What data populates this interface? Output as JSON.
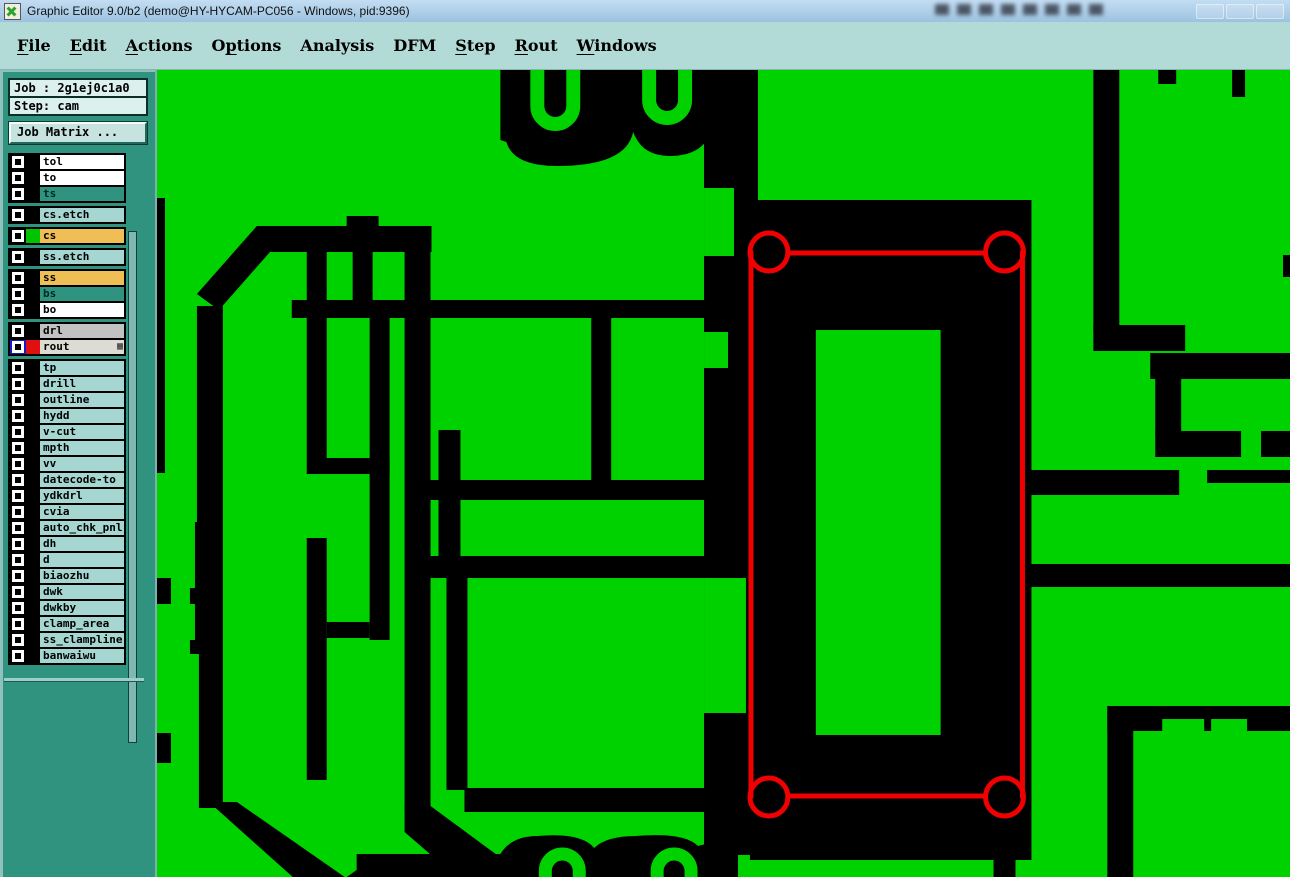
{
  "window": {
    "title": "Graphic Editor 9.0/b2 (demo@HY-HYCAM-PC056 - Windows, pid:9396)"
  },
  "menu": {
    "items": [
      {
        "label": "File",
        "u": 0
      },
      {
        "label": "Edit",
        "u": 0
      },
      {
        "label": "Actions",
        "u": 0
      },
      {
        "label": "Options",
        "u": 1
      },
      {
        "label": "Analysis",
        "u": -1
      },
      {
        "label": "DFM",
        "u": -1
      },
      {
        "label": "Step",
        "u": 0
      },
      {
        "label": "Rout",
        "u": 0
      },
      {
        "label": "Windows",
        "u": 0
      }
    ]
  },
  "job_panel": {
    "job": "Job : 2g1ej0c1a0",
    "step": "Step: cam",
    "matrix_button": "Job Matrix ..."
  },
  "layer_list": {
    "default_row_bg": "#a5d6d2",
    "groups": [
      {
        "rows": [
          {
            "name": "tol",
            "bg": "#ffffff"
          },
          {
            "name": "to",
            "bg": "#ffffff"
          },
          {
            "name": "ts",
            "bg": "#2f9380"
          }
        ]
      },
      {
        "rows": [
          {
            "name": "cs.etch",
            "bg": "#a5d6d2"
          }
        ]
      },
      {
        "rows": [
          {
            "name": "cs",
            "bg": "#efbf55",
            "swatch": "#00c400"
          }
        ]
      },
      {
        "rows": [
          {
            "name": "ss.etch",
            "bg": "#a5d6d2"
          }
        ]
      },
      {
        "rows": [
          {
            "name": "ss",
            "bg": "#efbf55"
          },
          {
            "name": "bs",
            "bg": "#2f9380"
          },
          {
            "name": "bo",
            "bg": "#ffffff"
          }
        ]
      },
      {
        "rows": [
          {
            "name": "drl",
            "bg": "#c2c2c2"
          },
          {
            "name": "rout",
            "bg": "#dcdcd4",
            "swatch": "#e01010",
            "selected": true,
            "grid_icon": true
          }
        ]
      },
      {
        "rows": [
          {
            "name": "tp"
          },
          {
            "name": "drill"
          },
          {
            "name": "outline"
          },
          {
            "name": "hydd"
          },
          {
            "name": "v-cut"
          },
          {
            "name": "mpth"
          },
          {
            "name": "vv"
          },
          {
            "name": "datecode-to"
          },
          {
            "name": "ydkdrl"
          },
          {
            "name": "cvia"
          },
          {
            "name": "auto_chk_pnl"
          },
          {
            "name": "dh"
          },
          {
            "name": "d"
          },
          {
            "name": "biaozhu"
          },
          {
            "name": "dwk"
          },
          {
            "name": "dwkby"
          },
          {
            "name": "clamp_area"
          },
          {
            "name": "ss_clampline"
          },
          {
            "name": "banwaiwu"
          }
        ]
      }
    ]
  },
  "canvas": {
    "layer_shown": "cs (copper) with rout outline overlay"
  },
  "colors": {
    "copper": "#00d200",
    "canvas_bg": "#000000",
    "rout_red": "#f00000",
    "titlebar_top": "#c3ddf2",
    "titlebar_bottom": "#9cc2e0",
    "menu_bg": "#b2dad6",
    "panel": "#2f9380",
    "panel_light": "#8fc2bc",
    "box_bg": "#dcf0ee",
    "box_border": "#0a2e28",
    "button_bg": "#c6e3df",
    "accent_blue": "#1818c0"
  }
}
